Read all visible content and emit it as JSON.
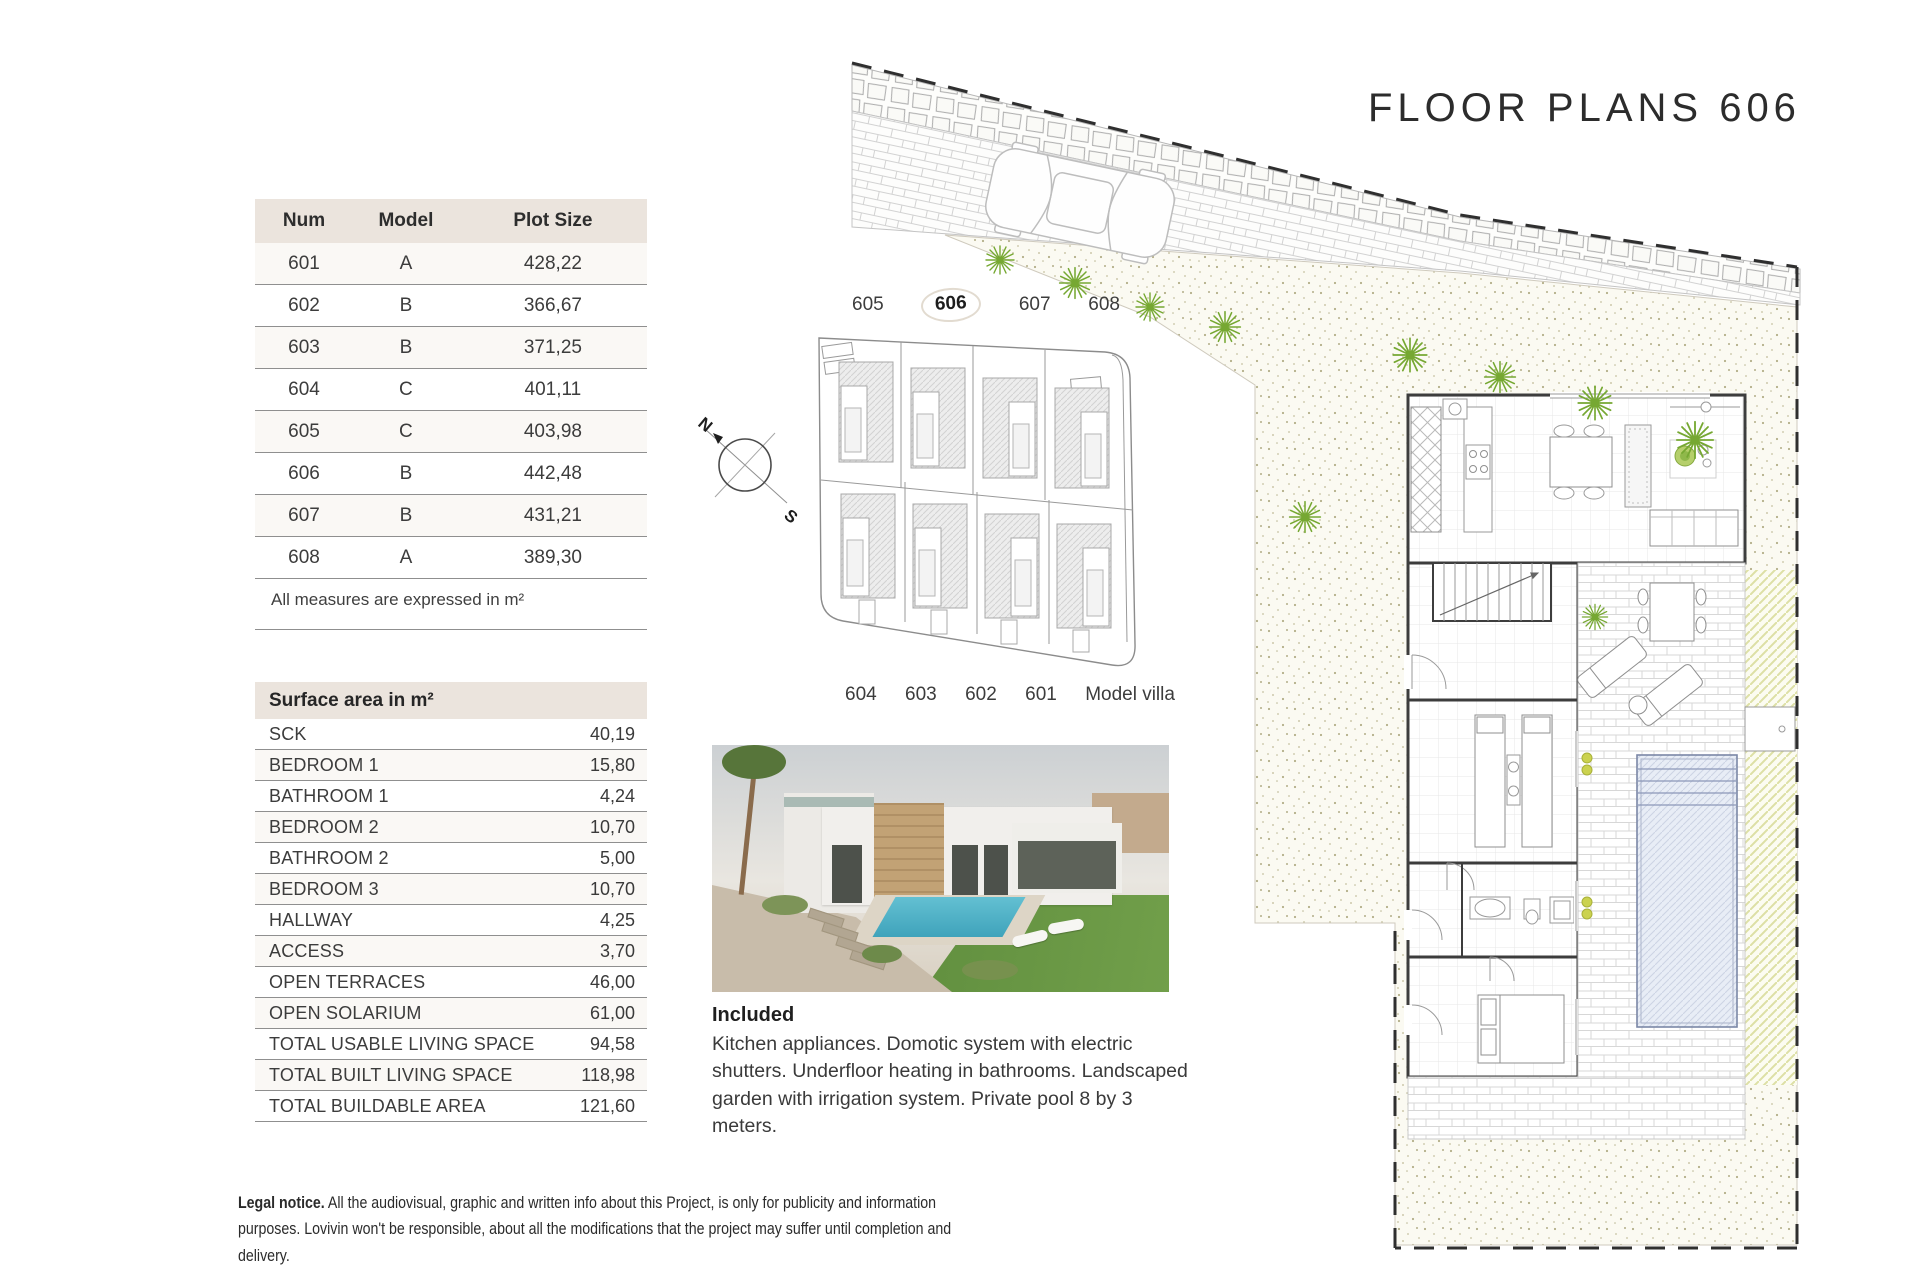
{
  "title": "FLOOR PLANS 606",
  "plot_table": {
    "headers": [
      "Num",
      "Model",
      "Plot Size"
    ],
    "rows": [
      [
        "601",
        "A",
        "428,22"
      ],
      [
        "602",
        "B",
        "366,67"
      ],
      [
        "603",
        "B",
        "371,25"
      ],
      [
        "604",
        "C",
        "401,11"
      ],
      [
        "605",
        "C",
        "403,98"
      ],
      [
        "606",
        "B",
        "442,48"
      ],
      [
        "607",
        "B",
        "431,21"
      ],
      [
        "608",
        "A",
        "389,30"
      ]
    ]
  },
  "measures_note": "All measures are expressed in m²",
  "surface_table": {
    "header": "Surface area in m²",
    "rows": [
      {
        "label": "SCK",
        "value": "40,19"
      },
      {
        "label": "BEDROOM 1",
        "value": "15,80"
      },
      {
        "label": "BATHROOM 1",
        "value": "4,24"
      },
      {
        "label": "BEDROOM 2",
        "value": "10,70"
      },
      {
        "label": "BATHROOM 2",
        "value": "5,00"
      },
      {
        "label": "BEDROOM 3",
        "value": "10,70"
      },
      {
        "label": "HALLWAY",
        "value": "4,25"
      },
      {
        "label": "ACCESS",
        "value": "3,70"
      },
      {
        "label": "OPEN TERRACES",
        "value": "46,00"
      },
      {
        "label": "OPEN SOLARIUM",
        "value": "61,00"
      },
      {
        "label": "TOTAL USABLE LIVING SPACE",
        "value": "94,58"
      },
      {
        "label": "TOTAL BUILT LIVING SPACE",
        "value": "118,98"
      },
      {
        "label": "TOTAL BUILDABLE AREA",
        "value": "121,60"
      }
    ]
  },
  "site_plan": {
    "top_labels": [
      "605",
      "606",
      "607",
      "608"
    ],
    "highlighted": "606",
    "bottom_labels": [
      "604",
      "603",
      "602",
      "601"
    ],
    "model_villa_label": "Model villa",
    "compass_north": "N",
    "compass_south": "S"
  },
  "included": {
    "heading": "Included",
    "body": "Kitchen appliances. Domotic system with electric shutters. Underfloor heating in bathrooms. Landscaped garden with irrigation system. Private pool 8 by 3 meters."
  },
  "legal": {
    "bold": "Legal notice.",
    "text": " All the audiovisual, graphic and written info about this Project, is only for publicity and information purposes. Lovivin won't be responsible, about all the modifications that the project may suffer until completion and delivery."
  },
  "colors": {
    "header_beige": "#ebe4dd",
    "plant_green": "#76a832",
    "pool_blue": "#e8edf6",
    "garden_dot": "#b3ae88",
    "boundary_dash": "#2f2f2f"
  }
}
